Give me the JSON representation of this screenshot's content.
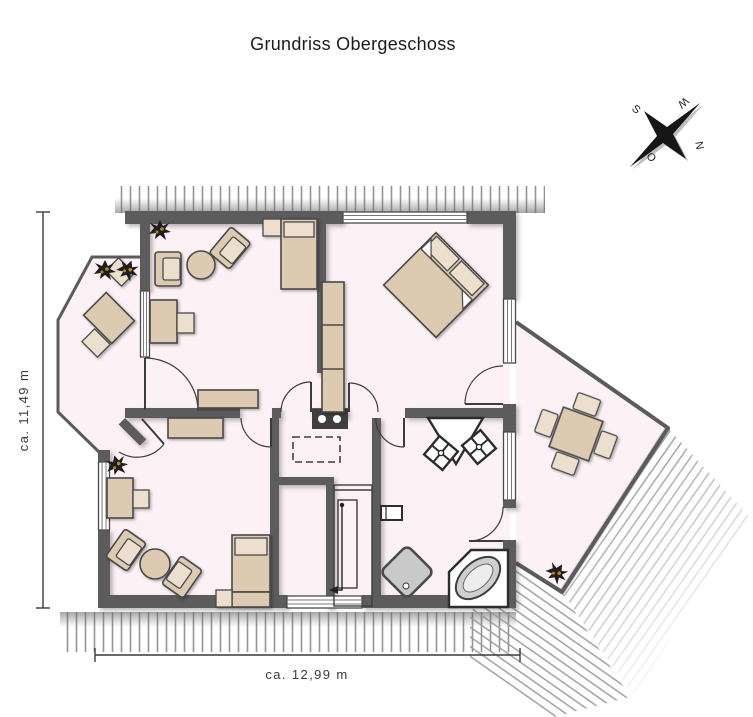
{
  "title": "Grundriss Obergeschoss",
  "dimensions": {
    "vertical": "ca. 11,49 m",
    "horizontal": "ca. 12,99 m"
  },
  "compass": {
    "n": "N",
    "e": "O",
    "s": "S",
    "w": "W"
  },
  "colors": {
    "title": "#1c1c1c",
    "wall": "#5b5b5b",
    "room": "#fcf1f4",
    "furniture": "#dccab1",
    "furniture_light": "#ecdfcd",
    "outline": "#4a4a4a",
    "hatch": "#949494",
    "shower": "#c9c9c9",
    "tub_rim": "#cfcfcf",
    "tub_inner": "#ededed",
    "line": "#3a3a3a",
    "plant": "#1e1e1e",
    "plant_accent": "#b9881c",
    "chimney": "#3f3f3f"
  }
}
